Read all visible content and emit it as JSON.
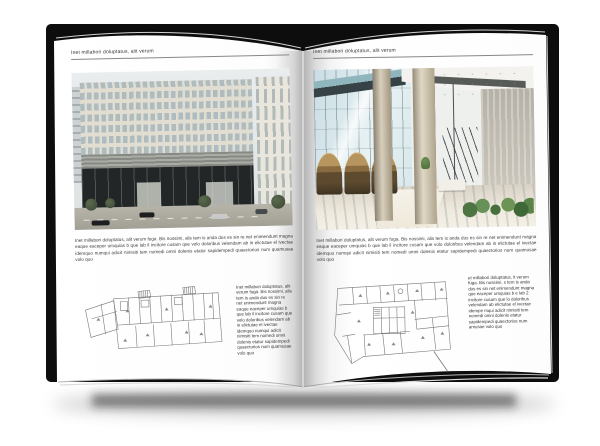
{
  "canvas": {
    "background": "#ffffff"
  },
  "book": {
    "cover_color": "#0d0d0d",
    "page_color": "#ffffff",
    "left_page": {
      "header": "Inet millabori doluptatus, alit verum",
      "body": "Inet millabori doluptatus, alit verum fuga. Bis nossimi, alis tem is anda dus es sin re net enimendunt magna eaque eaceper umquias b que lab il incitore cusam que volo doloribus velendam ab in elictutae el ivectae idemquo numqui adicit nimisiti tem nomedi omni dolenis etatur sapidempedi quaectorios num quamusae volo quo",
      "caption": "Inet millabori doluptatus, alit verum fuga. Bis nossimi, alis tem is anda dus es sin re net enimendunt magna eaque eaceper umquias b que lab il incitore cusam que volo doloribus velendam ab in elictutae el ivectae idemquo numqui adicit nimisiti tem nomedi omni dolenis etatur sapidempedi quaectorios num quamusae volo quo"
    },
    "right_page": {
      "header": "Inet millabori doluptatus, alit verum",
      "body": "Inet millabori doluptatus, alit verum fuga. Bis nossimi, alis tem is anda dus es sin re net enimendunt magna eaque eaceper umquias b que lab il incitore cusam que volo doloribus velendam ab in elictutae el ivectae idemquo numqui adicit nimisiti tem nomedi omni dolenis etatur sapidempedi quaectorios num quamusae volo quo",
      "caption": "et millabori doluptatus, it verum fuga. Bis nossimi, s tem is anda dus es sin net enimendunt magna que eaceper umquias b e lab 2 incitore cusam que lo doloribus velendam ab elictutae el ivectae idempe mqui adicit nimisiti tem nomedi omni dolenis etatur sapidempedi quaectorios num amusae volo quo"
    }
  }
}
